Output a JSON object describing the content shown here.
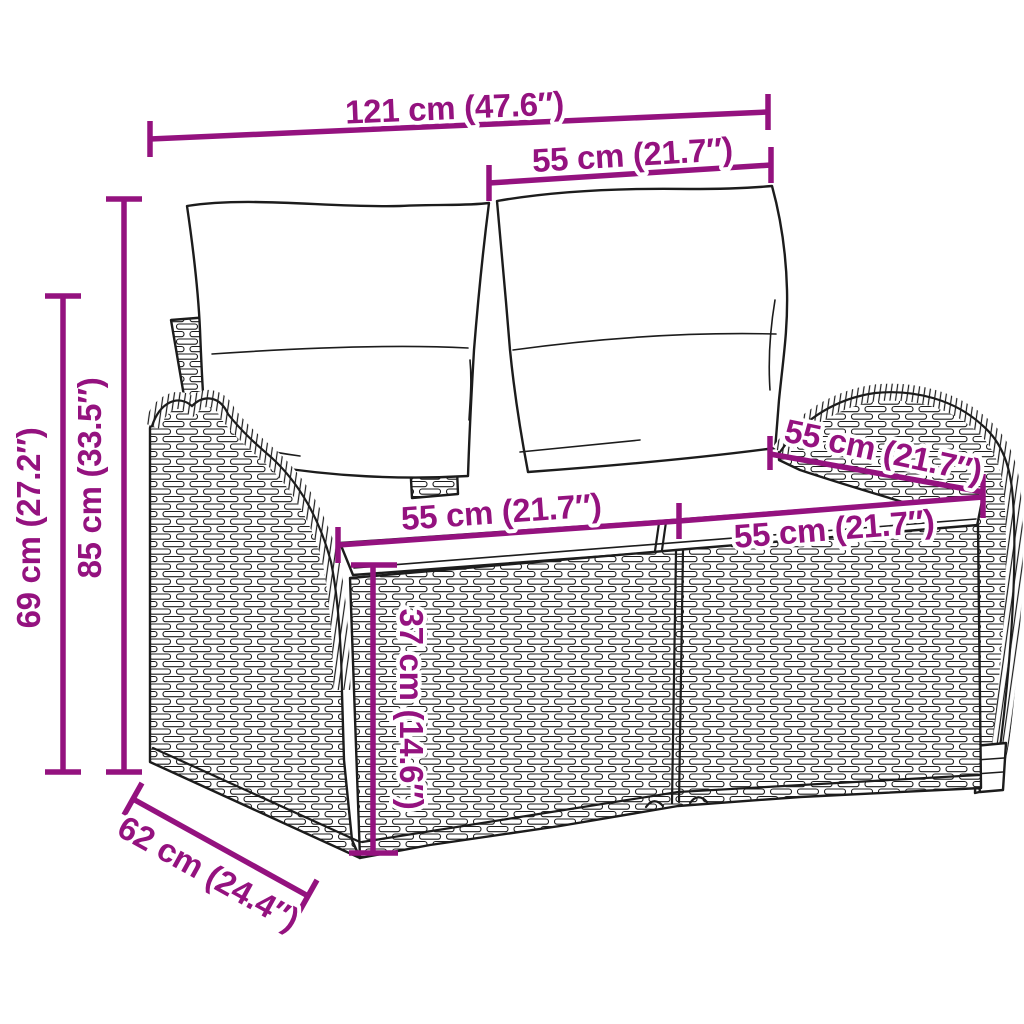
{
  "diagram": {
    "type": "product-dimension-diagram",
    "product": "poly rattan 2-seater garden bench with cushions",
    "accent_color": "#94127F",
    "ink_color": "#1C1C1C",
    "background_color": "#FFFFFF",
    "dimensions": {
      "overall_width": {
        "label": "121 cm (47.6″)",
        "value_cm": 121,
        "value_inch": 47.6
      },
      "section_width": {
        "label": "55 cm (21.7″)",
        "value_cm": 55,
        "value_inch": 21.7
      },
      "overall_height": {
        "label": "85 cm (33.5″)",
        "value_cm": 85,
        "value_inch": 33.5
      },
      "armrest_height": {
        "label": "69 cm (27.2″)",
        "value_cm": 69,
        "value_inch": 27.2
      },
      "seat_width_left": {
        "label": "55 cm (21.7″)",
        "value_cm": 55,
        "value_inch": 21.7
      },
      "seat_width_right": {
        "label": "55 cm (21.7″)",
        "value_cm": 55,
        "value_inch": 21.7
      },
      "seat_depth": {
        "label": "55 cm (21.7″)",
        "value_cm": 55,
        "value_inch": 21.7
      },
      "seat_height": {
        "label": "37 cm (14.6″)",
        "value_cm": 37,
        "value_inch": 14.6
      },
      "overall_depth": {
        "label": "62 cm (24.4″)",
        "value_cm": 62,
        "value_inch": 24.4
      }
    }
  }
}
